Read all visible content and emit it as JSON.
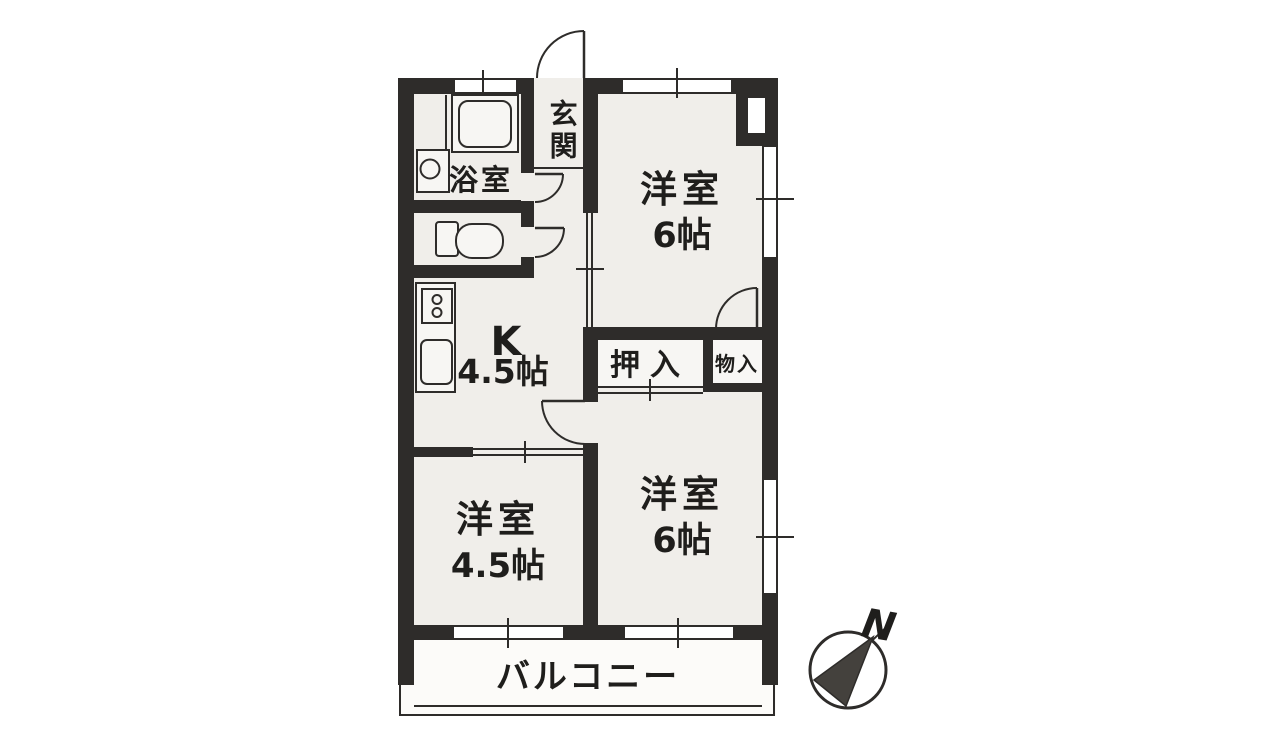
{
  "title": "apartment-floor-plan",
  "rooms": {
    "genkan": {
      "label": "玄関"
    },
    "bathroom": {
      "label": "浴室"
    },
    "kitchen": {
      "label": "K",
      "size": "4.5帖"
    },
    "western_room_top": {
      "label": "洋室",
      "size": "6帖"
    },
    "western_room_bottom_right": {
      "label": "洋室",
      "size": "6帖"
    },
    "western_room_bottom_left": {
      "label": "洋室",
      "size": "4.5帖"
    },
    "closet": {
      "label": "押入"
    },
    "storage": {
      "label": "物入"
    },
    "balcony": {
      "label": "バルコニー"
    }
  },
  "compass": {
    "north_label": "N"
  },
  "colors": {
    "wall": "#2e2c2a",
    "room_fill": "#f0eeea",
    "fixture_fill": "#f7f6f3",
    "arrow_fill": "#44413d",
    "background": "#ffffff"
  }
}
